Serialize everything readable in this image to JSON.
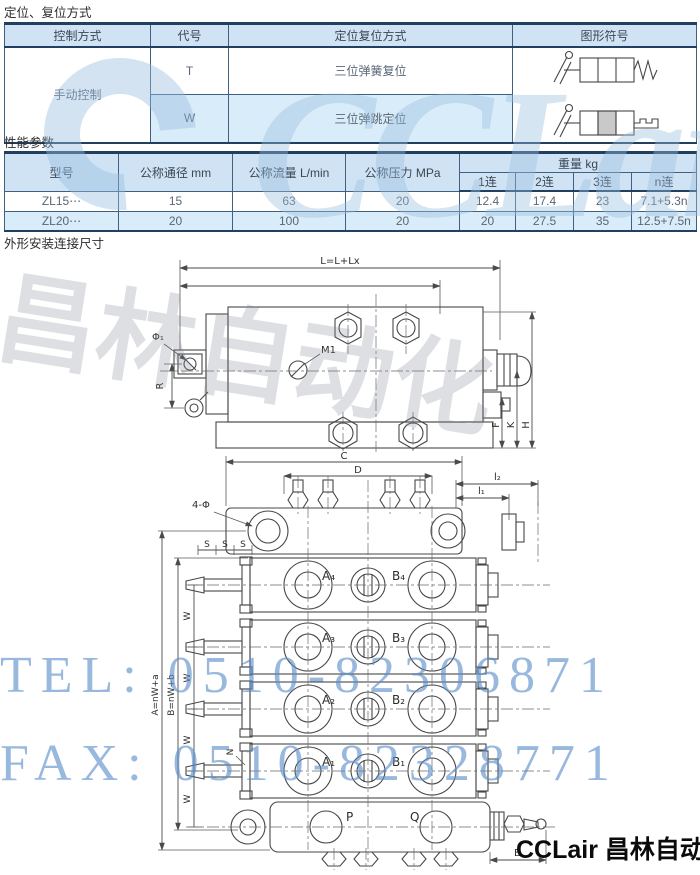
{
  "sections": {
    "positioning": "定位、复位方式",
    "performance": "性能参数",
    "dimensions": "外形安装连接尺寸"
  },
  "positioning_table": {
    "headers": [
      "控制方式",
      "代号",
      "定位复位方式",
      "图形符号"
    ],
    "control_method": "手动控制",
    "rows": [
      {
        "code": "T",
        "method": "三位弹簧复位",
        "symbol": "three-position-spring-return-symbol"
      },
      {
        "code": "W",
        "method": "三位弹跳定位",
        "symbol": "three-position-detent-symbol"
      }
    ]
  },
  "performance_table": {
    "headers": [
      "型号",
      "公称通径 mm",
      "公称流量 L/min",
      "公称压力 MPa"
    ],
    "weight_group_header": "重量 kg",
    "weight_subheaders": [
      "1连",
      "2连",
      "3连",
      "n连"
    ],
    "rows": [
      {
        "model": "ZL15⋯",
        "diameter": "15",
        "flow": "63",
        "pressure": "20",
        "weight_1": "12.4",
        "weight_2": "17.4",
        "weight_3": "23",
        "weight_n": "7.1+5.3n"
      },
      {
        "model": "ZL20⋯",
        "diameter": "20",
        "flow": "100",
        "pressure": "20",
        "weight_1": "20",
        "weight_2": "27.5",
        "weight_3": "35",
        "weight_n": "12.5+7.5n"
      }
    ]
  },
  "drawing_side_view": {
    "labels": {
      "overall_length": "L=L+Lx",
      "m1": "M1",
      "phi1": "Φ₁",
      "r": "R",
      "f": "F",
      "k": "K",
      "h": "H"
    }
  },
  "drawing_top_view": {
    "labels": {
      "c": "C",
      "d": "D",
      "mount_holes": "4-Φ",
      "l2": "l₂",
      "l1": "l₁",
      "s": "S",
      "w": "W",
      "a_formula": "A=nW+a",
      "b_formula": "B=nW+b",
      "n": "N",
      "p": "P",
      "q": "Q",
      "e": "E"
    },
    "ports": [
      {
        "a": "A₄",
        "b": "B₄"
      },
      {
        "a": "A₃",
        "b": "B₃"
      },
      {
        "a": "A₂",
        "b": "B₂"
      },
      {
        "a": "A₁",
        "b": "B₁"
      }
    ]
  },
  "watermarks": {
    "tel": "TEL: 0510-82306871",
    "fax": "FAX: 0510-82328771",
    "logo_latin": "CCLair",
    "logo_chinese": "昌林自动化"
  },
  "footer": {
    "brand": "CCLair 昌林自动化"
  },
  "colors": {
    "header_bg": "#cfe3f4",
    "row_alt_bg": "#d9ecf9",
    "table_line": "#416080",
    "table_line_dark": "#21405f",
    "watermark_blue": "#5a8cc8",
    "drawing_line": "#474747"
  }
}
